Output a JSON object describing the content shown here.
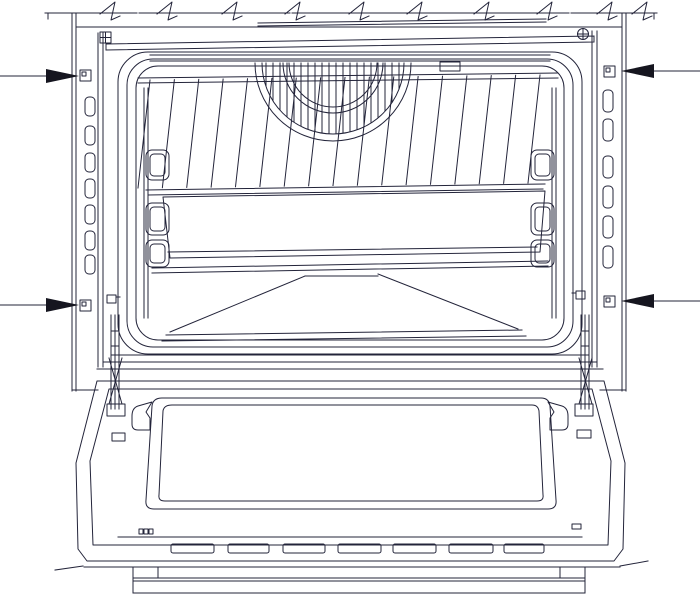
{
  "diagram": {
    "type": "technical-line-drawing",
    "subject": "built-in-oven-front-view-door-open-with-fixing-point-arrows",
    "colors": {
      "line": "#23243a",
      "arrow_fill": "#15151f",
      "background": "#ffffff"
    },
    "worktop": {
      "y": 13,
      "segments": [
        [
          45,
          137
        ],
        [
          145,
          290
        ],
        [
          298,
          569
        ],
        [
          577,
          657
        ]
      ],
      "dashes": [
        [
          139,
          144
        ],
        [
          292,
          297
        ],
        [
          571,
          576
        ]
      ],
      "end_ticks": [
        48,
        654
      ],
      "break_marks": [
        113,
        170,
        235,
        298,
        362,
        420,
        487,
        550,
        610,
        645
      ]
    },
    "arrows": [
      {
        "id": "top-left",
        "side": "left",
        "y": 76
      },
      {
        "id": "bottom-left",
        "side": "left",
        "y": 305
      },
      {
        "id": "top-right",
        "side": "right",
        "y": 71
      },
      {
        "id": "bottom-right",
        "side": "right",
        "y": 301
      }
    ],
    "fixing_holes": [
      {
        "x": 80,
        "y": 70
      },
      {
        "x": 80,
        "y": 300
      },
      {
        "x": 604,
        "y": 66
      },
      {
        "x": 604,
        "y": 296
      }
    ],
    "strip_slots": {
      "left": {
        "x": 85,
        "w": 10,
        "h": 19,
        "ys": [
          97,
          126,
          153,
          179,
          205,
          231,
          255
        ]
      },
      "right": {
        "x": 603,
        "w": 10,
        "h": 22,
        "ys": [
          90,
          119,
          156,
          186,
          216,
          246
        ]
      }
    },
    "rack": {
      "wires": 17,
      "x_start": 150,
      "x_end": 540,
      "top_y": 80,
      "top_slope": -5,
      "bottom_y": 188,
      "bottom_slope": -5,
      "lean": -12
    },
    "fan": {
      "cx": 333,
      "cy": 63,
      "radii": [
        78,
        71,
        50,
        44
      ],
      "fin_x1": 252,
      "fin_x2": 414,
      "fin_step": 7,
      "fin_y2": 140
    },
    "shelf_brackets": {
      "left_x": 146,
      "right_x": 531,
      "w": 23,
      "items": [
        {
          "y": 150,
          "h": 30
        },
        {
          "y": 203,
          "h": 32
        },
        {
          "y": 240,
          "h": 27
        }
      ]
    },
    "door_vents": {
      "y": 544,
      "h": 9,
      "slots": [
        {
          "x": 171,
          "w": 43
        },
        {
          "x": 228,
          "w": 41
        },
        {
          "x": 283,
          "w": 42
        },
        {
          "x": 338,
          "w": 43
        },
        {
          "x": 393,
          "w": 43
        },
        {
          "x": 449,
          "w": 44
        },
        {
          "x": 504,
          "w": 40
        }
      ]
    },
    "door_marks": {
      "cluster": {
        "x": 139,
        "y": 529,
        "count": 3
      },
      "right_rect": {
        "x": 572,
        "y": 524,
        "w": 9,
        "h": 5
      }
    }
  }
}
